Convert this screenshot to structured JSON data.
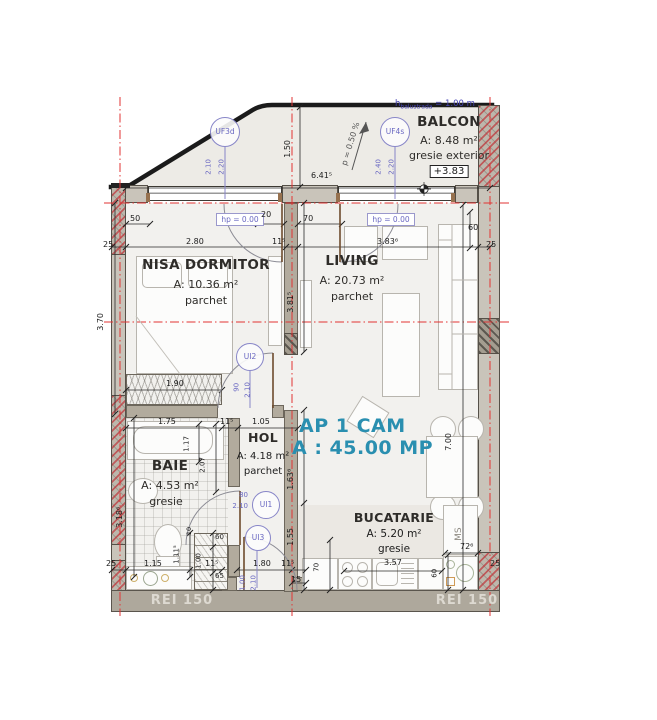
{
  "colors": {
    "accent_teal": "#2a8fb0",
    "axis_red": "#e23333",
    "opening_blue": "#6a68c2"
  },
  "plan": {
    "apartment": {
      "line1": "AP 1 CAM",
      "line2": "A : 45.00 MP"
    },
    "rooms": {
      "balcon": {
        "name": "BALCON",
        "area": "A: 8.48 m²",
        "finish": "gresie exterior",
        "level": "+3.83"
      },
      "dormitor": {
        "name": "NISA DORMITOR",
        "area": "A: 10.36 m²",
        "finish": "parchet"
      },
      "living": {
        "name": "LIVING",
        "area": "A: 20.73 m²",
        "finish": "parchet"
      },
      "baie": {
        "name": "BAIE",
        "area": "A: 4.53 m²",
        "finish": "gresie"
      },
      "hol": {
        "name": "HOL",
        "area": "A: 4.18 m²",
        "finish": "parchet"
      },
      "bucatarie": {
        "name": "BUCATARIE",
        "area": "A: 5.20 m²",
        "finish": "gresie"
      }
    },
    "openings": {
      "uf3d": {
        "id": "UF3d",
        "w": "2.10",
        "h": "2.20"
      },
      "uf4s": {
        "id": "UF4s",
        "w": "2.40",
        "h": "2.20"
      },
      "ui2": {
        "id": "UI2",
        "w": "90",
        "h": "2.10"
      },
      "ui1": {
        "id": "UI1",
        "w": "80",
        "h": "2.10"
      },
      "ui3": {
        "id": "UI3",
        "w": "1.00",
        "h": "2.10"
      }
    },
    "labels": {
      "hp": "hp = 0.00",
      "rei": "REI 150",
      "ms": "MS",
      "slope": "p = 0.50 %",
      "balustrade_h": "h",
      "balustrade_sub": "balustrada",
      "balustrade_eq": " = 1.00 m"
    },
    "dims": {
      "n10": "10",
      "n15": "15",
      "n20": "20",
      "n25": "25",
      "n50": "50",
      "n60": "60",
      "n65": "65",
      "n70": "70",
      "n115": "11⁵",
      "d100": "1.00",
      "d105": "1.05",
      "d111": "1.11⁵",
      "d115m": "1.15",
      "d117": "1.17",
      "d150": "1.50",
      "d155": "1.55",
      "d163": "1.63⁶",
      "d175": "1.75",
      "d180": "1.80",
      "d190": "1.90",
      "d207": "2.07",
      "d280": "2.80",
      "d318": "3.18⁶",
      "d357": "3.57",
      "d370": "3.70",
      "d381": "3.81⁵",
      "d383": "3.83⁶",
      "d641": "6.41⁵",
      "d700": "7.00",
      "d726": "72⁶"
    }
  }
}
